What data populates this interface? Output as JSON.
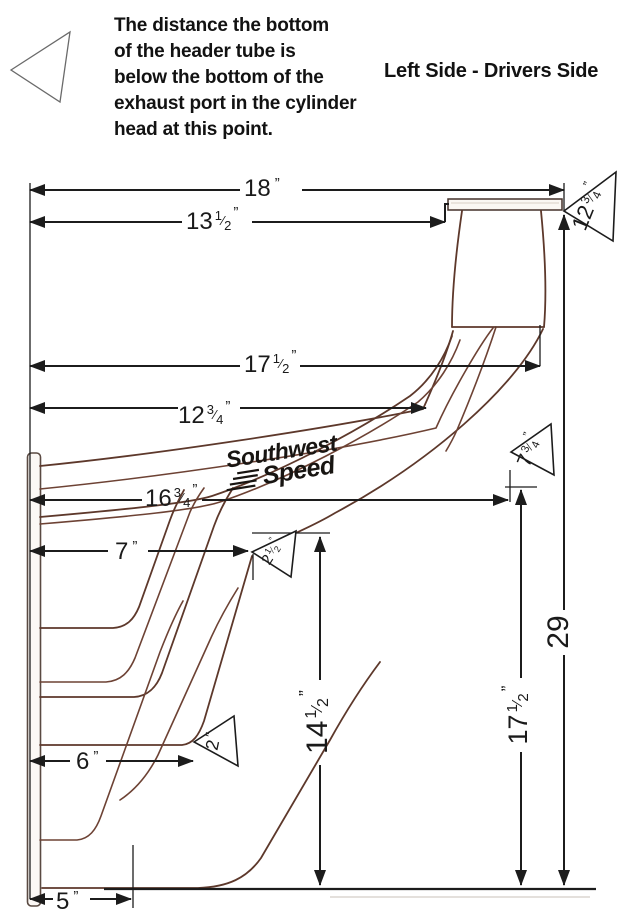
{
  "title": "Left Side  - Drivers Side",
  "note": {
    "lines": [
      "The distance the bottom",
      "of the header tube is",
      "below the bottom of the",
      "exhaust port in the cylinder",
      "head at this point."
    ]
  },
  "logo": {
    "line1": "Southwest",
    "line2": "Speed"
  },
  "colors": {
    "tube_ink": "#5d382b",
    "dimension_ink": "#1c1c1c"
  },
  "fraction_slash": "⁄",
  "dimensions": {
    "d18": {
      "whole": "18",
      "unit": "”"
    },
    "d13_1_2": {
      "whole": "13",
      "num": "1",
      "den": "2",
      "unit": "”"
    },
    "d17_1_2_top": {
      "whole": "17",
      "num": "1",
      "den": "2",
      "unit": "”"
    },
    "d12_3_4": {
      "whole": "12",
      "num": "3",
      "den": "4",
      "unit": "”"
    },
    "d16_3_4": {
      "whole": "16",
      "num": "3",
      "den": "4",
      "unit": "”"
    },
    "d7": {
      "whole": "7",
      "unit": "”"
    },
    "d6": {
      "whole": "6",
      "unit": "”"
    },
    "d5": {
      "whole": "5",
      "unit": "”"
    },
    "d14_1_2_v": {
      "whole": "14",
      "num": "1",
      "den": "2",
      "unit": "”"
    },
    "d17_1_2_v": {
      "whole": "17",
      "num": "1",
      "den": "2",
      "unit": "”"
    },
    "d29_v": {
      "whole": "29"
    }
  },
  "callouts": {
    "t12_3_4": {
      "whole": "12",
      "num": "3",
      "den": "4",
      "unit": "”"
    },
    "t7_3_4": {
      "whole": "7",
      "num": "3",
      "den": "4",
      "unit": "”"
    },
    "t2_1_2": {
      "whole": "2",
      "num": "1",
      "den": "2",
      "unit": "”"
    },
    "t2": {
      "whole": "2",
      "unit": "″"
    }
  }
}
